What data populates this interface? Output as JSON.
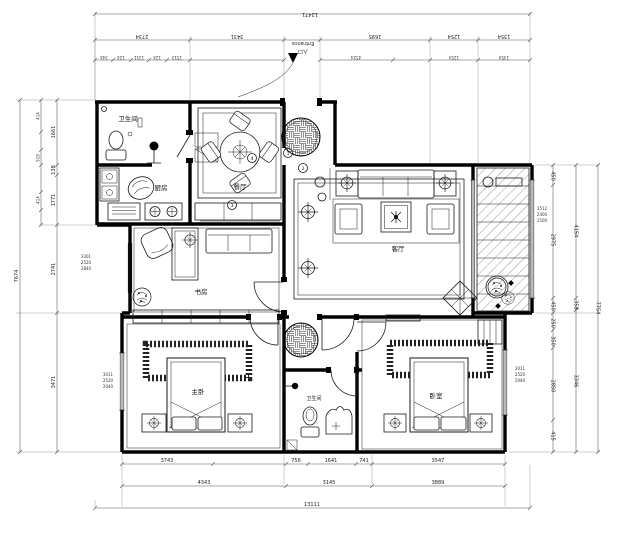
{
  "entrance": {
    "en": "Entrance",
    "cn": "入口"
  },
  "rooms": {
    "bath_top": "卫生间",
    "kitchen": "厨房",
    "dining": "餐厅",
    "living": "客厅",
    "study": "书房",
    "master": "主卧",
    "bath_bottom": "卫生间",
    "bedroom2": "卧室"
  },
  "markers": [
    "1",
    "2",
    "3",
    "4"
  ],
  "dims": {
    "top_total": "12471",
    "top_row2": [
      "2734",
      "3431",
      "1695",
      "1254",
      "1354"
    ],
    "top_row3": [
      "344",
      "124",
      "1311",
      "124",
      "1513",
      "4524",
      "1254",
      "1354"
    ],
    "bottom_row1": [
      "3743",
      "756",
      "1641",
      "741",
      "3547"
    ],
    "bottom_row2": [
      "4343",
      "3145",
      "3889"
    ],
    "bottom_total": "13111",
    "left_total": "7674",
    "left_col": [
      "1661",
      "138",
      "1771",
      "2741",
      "3471"
    ],
    "left_inner": [
      "414",
      "519",
      "414"
    ],
    "right_col1": [
      "450",
      "2975",
      "450",
      "250",
      "350",
      "2850",
      "415"
    ],
    "right_col2": [
      "4154",
      "358",
      "3346"
    ],
    "right_total": "7754",
    "note_left_1": [
      "3301",
      "2520",
      "2840"
    ],
    "note_left_2": [
      "3011",
      "2520",
      "2040"
    ],
    "note_right_1": [
      "3512",
      "2400",
      "1500"
    ],
    "note_right_2": [
      "3011",
      "2520",
      "2040"
    ]
  }
}
